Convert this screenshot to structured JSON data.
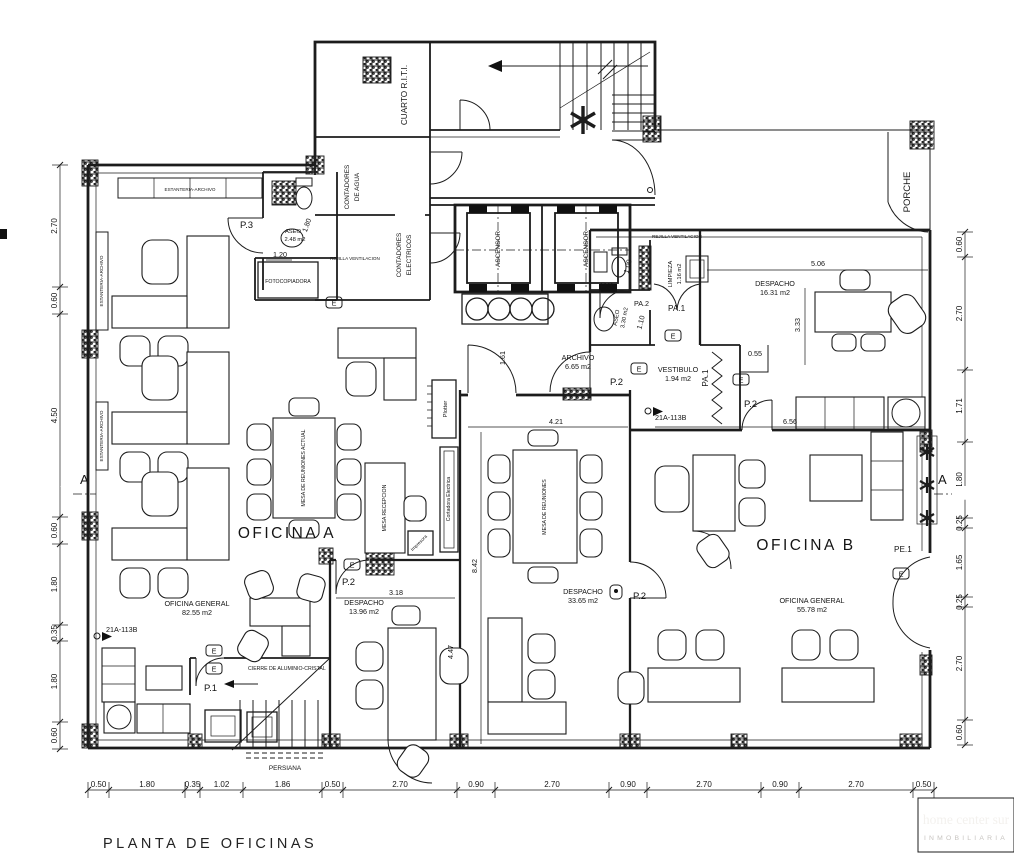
{
  "title": "PLANTA DE OFICINAS",
  "logo": {
    "line1": "home center sur",
    "line2": "INMOBILIARIA"
  },
  "section_marker": "A",
  "rooms": {
    "oficina_a": "OFICINA A",
    "oficina_a_general": "OFICINA GENERAL",
    "oficina_a_area": "82.55 m2",
    "oficina_b": "OFICINA B",
    "oficina_b_general": "OFICINA GENERAL",
    "oficina_b_area": "55.78 m2",
    "despacho": "DESPACHO",
    "despacho_central_area": "33.65 m2",
    "despacho_left_area": "13.96 m2",
    "despacho_right_area": "16.31 m2",
    "archivo": "ARCHIVO",
    "archivo_area": "6.65 m2",
    "vestibulo": "VESTIBULO",
    "vestibulo_area": "1.94 m2",
    "limpieza": "LIMPIEZA",
    "limpieza_area": "1.16 m2",
    "aseo": "ASEO",
    "aseo_top_area": "2.48 m2",
    "aseo_mid_area": "3.30 m2",
    "cuarto_riti": "CUARTO R.I.T.I.",
    "contadores_agua_1": "CONTADORES",
    "contadores_agua_2": "DE AGUA",
    "contadores_elec_1": "CONTADORES",
    "contadores_elec_2": "ELECTRICOS",
    "ascensor": "ASCENSOR",
    "porche": "PORCHE",
    "fotocopiadora": "FOTOCOPIADORA"
  },
  "furniture": {
    "mesa_reuniones_actual": "MESA DE REUNIONES ACTUAL",
    "mesa_reuniones": "MESA DE REUNIONES",
    "mesa_recepcion": "MESA RECEPCION",
    "plotter": "Plotter",
    "cortadora": "Cortadora Electrica",
    "estanteria": "ESTANTERIA-ARCHIVO",
    "impresora": "Impresora"
  },
  "doors": {
    "p1": "P.1",
    "p2": "P.2",
    "p3": "P.3",
    "pa1": "PA.1",
    "pa2": "PA.2",
    "pe1": "PE.1",
    "e": "E"
  },
  "notes": {
    "persiana": "PERSIANA",
    "cierre": "CIERRE DE ALUMINIO-CRISTAL",
    "rejilla": "REJILLA VENTILACION",
    "ref": "21A-113B"
  },
  "dims": {
    "bottom": [
      "0.50",
      "1.80",
      "0.35",
      "1.02",
      "1.86",
      "0.50",
      "2.70",
      "0.90",
      "2.70",
      "0.90",
      "2.70",
      "0.90",
      "2.70",
      "0.50"
    ],
    "left": [
      "2.70",
      "0.60",
      "4.50",
      "0.60",
      "1.80",
      "0.35",
      "1.80",
      "0.60"
    ],
    "right": [
      "0.60",
      "2.70",
      "1.71",
      "1.80",
      "0.25",
      "1.65",
      "0.25",
      "2.70",
      "0.60"
    ],
    "d506": "5.06",
    "d333": "3.33",
    "d421": "4.21",
    "d842": "8.42",
    "d656": "6.56",
    "d318": "3.18",
    "d447": "4.47",
    "d161": "1.61",
    "d120": "1.20",
    "d180": "1.80",
    "d100": "1.00",
    "d110": "1.10",
    "d055": "0.55"
  }
}
